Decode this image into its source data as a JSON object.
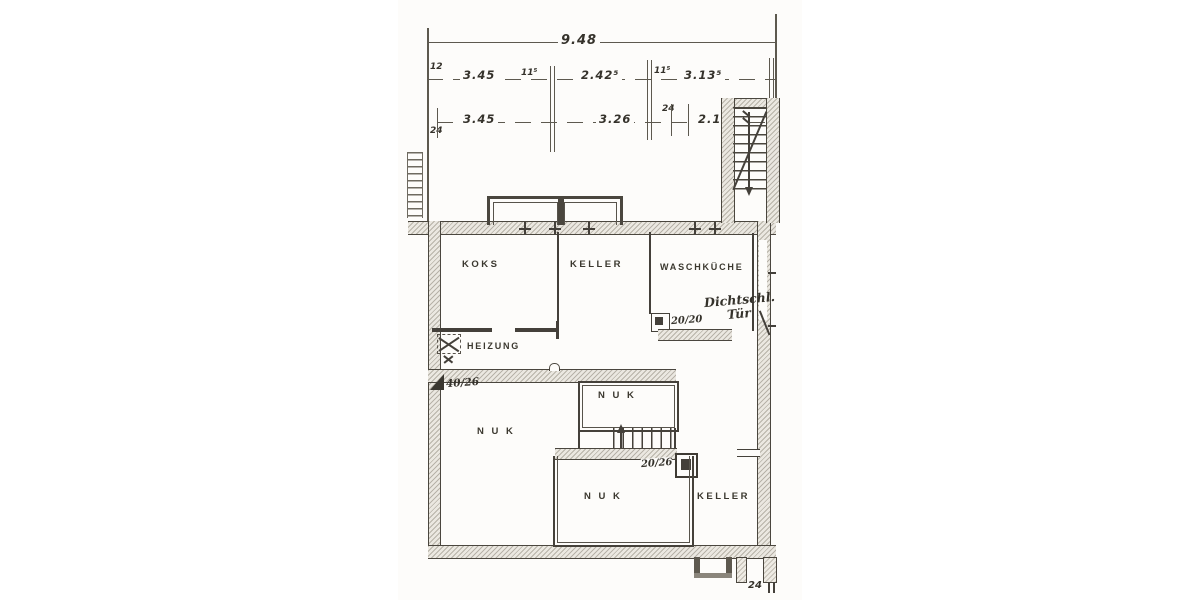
{
  "dims": {
    "total": "9.48",
    "t12": "12",
    "r2a": "3.45",
    "r2b": "11⁵",
    "r2c": "2.42⁵",
    "r2d": "11⁵",
    "r2e": "3.13⁵",
    "r3_24": "24",
    "r3a": "3.45",
    "r3b": "3.26",
    "r3c": "24",
    "r3d": "2.17⁵",
    "b24": "24"
  },
  "rooms": {
    "koks": "KOKS",
    "keller_upper": "KELLER",
    "waschkueche": "WASCHKÜCHE",
    "heizung": "HEIZUNG",
    "nuk_left": "N U K",
    "nuk_upper": "N U K",
    "nuk_lower": "N U K",
    "keller_lower": "KELLER"
  },
  "notes": {
    "dicht1": "Dichtschl.",
    "dicht2": "Tür",
    "p2020": "20/20",
    "p4026": "40/26",
    "p2026": "20/26"
  }
}
